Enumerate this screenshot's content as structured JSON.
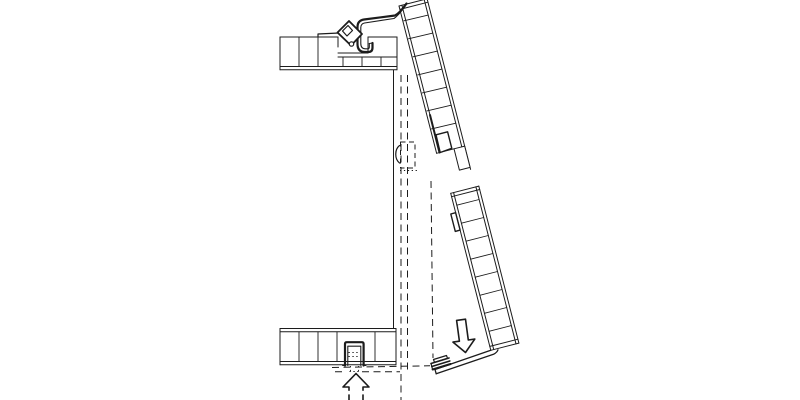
{
  "canvas": {
    "width": 800,
    "height": 400,
    "background": "#ffffff",
    "line_color": "#1c1c1c"
  },
  "diagram": {
    "kind": "architectural-section-detail",
    "groups": [
      "top-slab",
      "bottom-slab",
      "closed-position-dashes",
      "actuator-dashed-box",
      "upper-panel",
      "lower-panel",
      "panel-joint",
      "hinge-assembly",
      "bottom-bracket",
      "flap-bottom-profile",
      "down-arrow-icon",
      "up-arrow-icon"
    ],
    "elements": [
      {
        "n": "top-slab-top-line-left",
        "g": "top-slab",
        "k": "path",
        "d": "M280,37 L338,37",
        "w": 1
      },
      {
        "n": "top-slab-notch-left-wall",
        "g": "top-slab",
        "k": "path",
        "d": "M338,37 L338,47",
        "w": 1
      },
      {
        "n": "top-slab-notch-floor",
        "g": "top-slab",
        "k": "path",
        "d": "M338,53 L368,53",
        "w": 1
      },
      {
        "n": "top-slab-notch-right-wall",
        "g": "top-slab",
        "k": "path",
        "d": "M368,53 L368,37",
        "w": 1
      },
      {
        "n": "top-slab-top-line-right",
        "g": "top-slab",
        "k": "path",
        "d": "M368,37 L397,37",
        "w": 1
      },
      {
        "n": "top-slab-rabbet-line",
        "g": "top-slab",
        "k": "path",
        "d": "M338,57 L397,57",
        "w": 1
      },
      {
        "n": "top-slab-bottom-line-1",
        "g": "top-slab",
        "k": "path",
        "d": "M280,66.5 L397,66.5",
        "w": 1
      },
      {
        "n": "top-slab-bottom-line-2",
        "g": "top-slab",
        "k": "path",
        "d": "M280,69.8 L397,69.8",
        "w": 1
      },
      {
        "n": "top-slab-left-cap",
        "g": "top-slab",
        "k": "path",
        "d": "M280,37 L280,69.8",
        "w": 1
      },
      {
        "n": "top-slab-right-cap",
        "g": "top-slab",
        "k": "path",
        "d": "M397,37 L397,69.8",
        "w": 1
      },
      {
        "n": "top-slab-ribs",
        "g": "top-slab",
        "k": "path",
        "d": "M299,37 L299,66.5 M318,37 L318,66.5",
        "w": 0.9
      },
      {
        "n": "top-slab-short-ribs",
        "g": "top-slab",
        "k": "path",
        "d": "M343,57 L343,66.5 M362,57 L362,66.5 M381,57 L381,66.5",
        "w": 0.9
      },
      {
        "n": "hinge-shim-plate",
        "g": "hinge-assembly",
        "k": "path",
        "d": "M318,34 L339,33 M318,34 L318,37",
        "w": 1.2
      },
      {
        "n": "jamb-line",
        "g": "closed-position-dashes",
        "k": "path",
        "d": "M393.5,70 L393.5,328.5",
        "w": 1
      },
      {
        "n": "closed-flap-outer-face",
        "g": "closed-position-dashes",
        "k": "path",
        "d": "M401,75 L401,400",
        "w": 1,
        "da": "7 4.5"
      },
      {
        "n": "closed-flap-inner-face",
        "g": "closed-position-dashes",
        "k": "path",
        "d": "M407.5,75 L407.5,372",
        "w": 1,
        "da": "7 4.5"
      },
      {
        "n": "open-flap-projection-line",
        "g": "closed-position-dashes",
        "k": "path",
        "d": "M431,181 L433,358",
        "w": 1,
        "da": "7 4.5"
      },
      {
        "n": "sill-projection-dash-1",
        "g": "closed-position-dashes",
        "k": "path",
        "d": "M332,367.5 L430,365.8",
        "w": 1,
        "da": "7 4.5"
      },
      {
        "n": "sill-projection-dash-2",
        "g": "closed-position-dashes",
        "k": "path",
        "d": "M335,371.8 L345,371.8 M362,371.8 L400,371.8",
        "w": 1,
        "da": "7 4.5"
      },
      {
        "n": "actuator-box-dashed",
        "g": "actuator-dashed-box",
        "k": "path",
        "d": "M400.5,142 L415,142 L415,168 L400.5,168 Z",
        "w": 1,
        "da": "5 3.5"
      },
      {
        "n": "actuator-handle-arc",
        "g": "actuator-dashed-box",
        "k": "path",
        "d": "M399.5,145.5 C394.5,149.5 394.5,159 399.5,163",
        "w": 1.2
      },
      {
        "n": "actuator-dotted-line",
        "g": "actuator-dashed-box",
        "k": "path",
        "d": "M400,170.5 L418,170.5",
        "w": 0.9,
        "da": "1.3 2.6"
      },
      {
        "n": "upper-panel-left-outer",
        "g": "upper-panel",
        "k": "path",
        "d": "M399,6 L436.6,153.3",
        "w": 1
      },
      {
        "n": "upper-panel-left-inner",
        "g": "upper-panel",
        "k": "path",
        "d": "M401.9,5.3 L430,115",
        "w": 1
      },
      {
        "n": "upper-panel-left-inner-thick",
        "g": "upper-panel",
        "k": "path",
        "d": "M430,115 L439.5,152.5",
        "w": 2
      },
      {
        "n": "upper-panel-right-outer",
        "g": "upper-panel",
        "k": "path",
        "d": "M427.1,-1.2 L470.6,169.4",
        "w": 1
      },
      {
        "n": "upper-panel-right-inner",
        "g": "upper-panel",
        "k": "path",
        "d": "M424.2,-0.4 L467,167.2",
        "w": 1
      },
      {
        "n": "upper-panel-top-cap",
        "g": "upper-panel",
        "k": "path",
        "d": "M399,6 L427.1,-1.2",
        "w": 1
      },
      {
        "n": "upper-panel-top-cap-inner",
        "g": "upper-panel",
        "k": "path",
        "d": "M399.9,9.4 L428,2.2",
        "w": 1
      },
      {
        "n": "upper-panel-rungs",
        "g": "upper-panel",
        "k": "path",
        "d": "M403.9,20.8 L428.2,15.1 M408.5,38.8 L432.8,33.1 M413.1,56.8 L437.4,51.1 M417.7,74.9 L442,69.1 M422.3,92.9 L446.6,87.2 M426.9,110.9 L451.2,105.2 M431.5,128.9 L455.8,123.2",
        "w": 0.9
      },
      {
        "n": "upper-panel-end-line",
        "g": "upper-panel",
        "k": "path",
        "d": "M436.6,153.3 L454,148.8",
        "w": 1
      },
      {
        "n": "upper-panel-joint-notch",
        "g": "panel-joint",
        "k": "path",
        "d": "M436,134.8 L447.6,131.8 L451.8,148.3 L440.2,152.5 Z",
        "w": 1.4,
        "f": "#ffffff"
      },
      {
        "n": "upper-panel-joint-tongue",
        "g": "panel-joint",
        "k": "path",
        "d": "M454,148.8 L464.7,146.1 L470.1,167.4 L459.4,170.1 Z",
        "w": 1,
        "f": "#ffffff"
      },
      {
        "n": "lower-panel-left-outer",
        "g": "lower-panel",
        "k": "path",
        "d": "M450.7,193.3 L490.8,350.3",
        "w": 1
      },
      {
        "n": "lower-panel-left-inner",
        "g": "lower-panel",
        "k": "path",
        "d": "M453.6,192.6 L493.7,349.5",
        "w": 1
      },
      {
        "n": "lower-panel-right-outer",
        "g": "lower-panel",
        "k": "path",
        "d": "M478.8,186.1 L518.9,343.1",
        "w": 1
      },
      {
        "n": "lower-panel-right-inner",
        "g": "lower-panel",
        "k": "path",
        "d": "M475.9,186.9 L516,343.9",
        "w": 1
      },
      {
        "n": "lower-panel-top-cap",
        "g": "lower-panel",
        "k": "path",
        "d": "M450.7,193.3 L478.8,186.1",
        "w": 1
      },
      {
        "n": "lower-panel-top-cap-inner",
        "g": "lower-panel",
        "k": "path",
        "d": "M451.6,196.7 L479.7,189.5",
        "w": 1
      },
      {
        "n": "lower-panel-bottom-cap",
        "g": "lower-panel",
        "k": "path",
        "d": "M490.8,350.3 L518.9,343.1",
        "w": 1
      },
      {
        "n": "lower-panel-bottom-cap-inner",
        "g": "lower-panel",
        "k": "path",
        "d": "M489.8,346.4 L517.9,339.2",
        "w": 1
      },
      {
        "n": "lower-panel-joint-notch",
        "g": "panel-joint",
        "k": "path",
        "d": "M450.8,214 L455.6,212.7 L460.1,230.1 L455.3,231.4 Z",
        "w": 1.4,
        "f": "#ffffff"
      },
      {
        "n": "lower-panel-rungs",
        "g": "lower-panel",
        "k": "path",
        "d": "M456.8,205.2 L479.1,199.5 M461.4,223.2 L483.7,217.5 M466,241.2 L488.3,235.5 M470.6,259.2 L492.9,253.5 M475.2,277.2 L497.5,271.5 M479.8,295.3 L502.1,289.5 M484.4,313.3 L506.7,307.5 M489,331.3 L511.3,325.6",
        "w": 0.9
      },
      {
        "n": "hinge-hook-outer",
        "g": "hinge-assembly",
        "k": "path",
        "d": "M406.5,3.5 Q400,13 395,15.5 L364,19.5 Q357.5,20.5 357.5,27 L357.5,44 Q357.5,52 365,52 L368.5,52 Q372.5,52 372.5,47.5 L372.5,43",
        "w": 2.2
      },
      {
        "n": "hinge-hook-inner",
        "g": "hinge-assembly",
        "k": "path",
        "d": "M404,7.5 Q398.5,15.5 394,18.5 L364.5,23 Q360.8,23.8 360.8,27.5 L360.8,43.5 Q360.8,48.8 365.5,48.8 L367.8,48.8 Q369.3,48.8 369.3,47 L369.3,43.5",
        "w": 1.1
      },
      {
        "n": "hinge-hook-tip-cap",
        "g": "hinge-assembly",
        "k": "path",
        "d": "M372.5,43 L369.3,43.5",
        "w": 1.1
      },
      {
        "n": "hinge-clamp-body",
        "g": "hinge-assembly",
        "k": "path",
        "d": "M349,21 L362,34 L351,45.5 L337.5,32.5 Z",
        "w": 1.8,
        "f": "#ffffff"
      },
      {
        "n": "hinge-clamp-notch",
        "g": "hinge-assembly",
        "k": "path",
        "d": "M342.5,31 L348,25.5 L352.5,30.5 L347,36 Z",
        "w": 1.2,
        "f": "#ffffff"
      },
      {
        "n": "hinge-clamp-fold-line",
        "g": "hinge-assembly",
        "k": "path",
        "d": "M341.5,36.5 L350,44.5",
        "w": 1.1
      },
      {
        "n": "hinge-clamp-curl",
        "g": "hinge-assembly",
        "k": "circle",
        "cx": 351.5,
        "cy": 44,
        "r": 2.2,
        "w": 1.2,
        "f": "#ffffff"
      },
      {
        "n": "bottom-slab-top-line-1",
        "g": "bottom-slab",
        "k": "path",
        "d": "M280,328.5 L396,328.5",
        "w": 1
      },
      {
        "n": "bottom-slab-top-line-2",
        "g": "bottom-slab",
        "k": "path",
        "d": "M280,331.8 L396,331.8",
        "w": 1
      },
      {
        "n": "bottom-slab-bottom-line-1",
        "g": "bottom-slab",
        "k": "path",
        "d": "M280,361.5 L396,361.5",
        "w": 1
      },
      {
        "n": "bottom-slab-bottom-line-2",
        "g": "bottom-slab",
        "k": "path",
        "d": "M280,364.8 L396,364.8",
        "w": 1
      },
      {
        "n": "bottom-slab-left-cap",
        "g": "bottom-slab",
        "k": "path",
        "d": "M280,328.5 L280,364.8",
        "w": 1
      },
      {
        "n": "bottom-slab-right-cap",
        "g": "bottom-slab",
        "k": "path",
        "d": "M396,328.5 L396,364.8",
        "w": 1
      },
      {
        "n": "bottom-slab-ribs",
        "g": "bottom-slab",
        "k": "path",
        "d": "M299,331.8 L299,361.5 M318,331.8 L318,361.5 M337,331.8 L337,361.5 M375,331.8 L375,361.5",
        "w": 0.9
      },
      {
        "n": "sill-bracket-outer",
        "g": "bottom-bracket",
        "k": "path",
        "d": "M345,365.5 L345,344 Q345,342.2 346.8,342.2 L361.8,342.2 Q363.6,342.2 363.6,344 L363.6,365.5",
        "w": 2.2
      },
      {
        "n": "sill-bracket-inner",
        "g": "bottom-bracket",
        "k": "path",
        "d": "M347.8,365.5 L347.8,346.2 L360.8,346.2 L360.8,365.5",
        "w": 1.1
      },
      {
        "n": "sill-bracket-feet",
        "g": "bottom-bracket",
        "k": "path",
        "d": "M342.6,365.5 L345,365.5 M363.6,365.5 L366,365.5",
        "w": 1.1
      },
      {
        "n": "sill-bracket-hidden-h",
        "g": "bottom-bracket",
        "k": "path",
        "d": "M348.5,352.5 L360,352.5 M348.5,356.5 L360,356.5",
        "w": 0.9,
        "da": "1.3 2.6"
      },
      {
        "n": "sill-bracket-hidden-v",
        "g": "bottom-bracket",
        "k": "path",
        "d": "M350.5,366 L350.5,372 M358.5,366 L358.5,372",
        "w": 0.9,
        "da": "1.3 2.6"
      },
      {
        "n": "sill-bracket-hidden-h2",
        "g": "bottom-bracket",
        "k": "path",
        "d": "M349.5,371.5 L359.5,371.5",
        "w": 0.9,
        "da": "1.3 2.6"
      },
      {
        "n": "flap-bottom-bar-upper",
        "g": "flap-bottom-profile",
        "k": "path",
        "d": "M435,369.5 L490.8,350.3",
        "w": 1.3
      },
      {
        "n": "flap-bottom-bar-lower",
        "g": "flap-bottom-profile",
        "k": "path",
        "d": "M436.2,373.8 L493.5,354.3 Q497,352.5 498,349.8",
        "w": 1.3
      },
      {
        "n": "flap-bottom-bar-left-cap",
        "g": "flap-bottom-profile",
        "k": "path",
        "d": "M435,369.5 L436.2,373.8",
        "w": 1.3
      },
      {
        "n": "flap-hook-plate",
        "g": "flap-bottom-profile",
        "k": "path",
        "d": "M433.5,359.5 L446.5,355.5 L447.5,358.3 L434.5,362.3 Z",
        "w": 1.2,
        "f": "#ffffff"
      },
      {
        "n": "flap-hook-lamination-1",
        "g": "flap-bottom-profile",
        "k": "path",
        "d": "M431,363.5 L449,358",
        "w": 1.6
      },
      {
        "n": "flap-hook-lamination-2",
        "g": "flap-bottom-profile",
        "k": "path",
        "d": "M431.8,366.5 L449.8,361",
        "w": 1.6
      },
      {
        "n": "flap-hook-lamination-3",
        "g": "flap-bottom-profile",
        "k": "path",
        "d": "M432.6,369.5 L450.6,364",
        "w": 2
      },
      {
        "n": "flap-hook-cap",
        "g": "flap-bottom-profile",
        "k": "path",
        "d": "M431,363.5 L432.6,369.5",
        "w": 1.2
      },
      {
        "n": "down-arrow",
        "g": "down-arrow-icon",
        "k": "path",
        "d": "M465.5,352.5 L452.98,342.1 L459.4,341.2 L456.6,320.4 L465.5,319.2 L468.3,340 L474.8,339.1 Z",
        "w": 1.6,
        "f": "#ffffff"
      },
      {
        "n": "up-arrow",
        "g": "up-arrow-icon",
        "k": "path",
        "d": "M356,373.5 L343,387 L349,387 L349,400.8 L363,400.8 L363,387 L369,387 Z",
        "w": 1.6,
        "f": "#ffffff"
      },
      {
        "n": "up-arrow-dash-gap-left",
        "g": "up-arrow-icon",
        "k": "rect",
        "x": 347.8,
        "y": 390.8,
        "wd": 2.4,
        "h": 3.6,
        "w": 0,
        "f": "#ffffff"
      },
      {
        "n": "up-arrow-dash-gap-right",
        "g": "up-arrow-icon",
        "k": "rect",
        "x": 361.8,
        "y": 390.8,
        "wd": 2.4,
        "h": 3.6,
        "w": 0,
        "f": "#ffffff"
      }
    ]
  }
}
